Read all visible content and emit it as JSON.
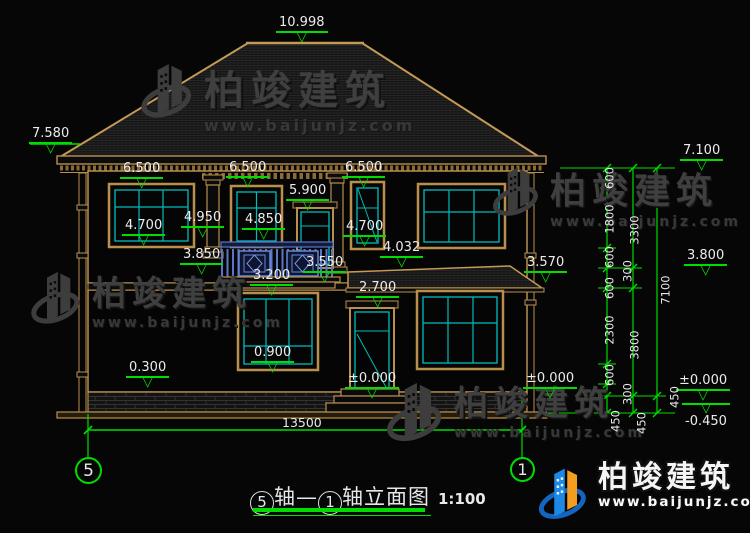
{
  "watermark": {
    "brand": "柏竣建筑",
    "url": "www.baijunjz.com"
  },
  "footer_logo": {
    "brand": "柏竣建筑",
    "url": "www.baijunjz.com"
  },
  "title": {
    "axis1": "5",
    "mid": "轴—",
    "axis2": "1",
    "tail": "轴立面图",
    "scale": "1:100"
  },
  "axes": {
    "left": "5",
    "right": "1"
  },
  "elev": {
    "ridge": "10.998",
    "eaveL": "7.580",
    "eaveR": "7.100",
    "l2a": "6.500",
    "l2b": "6.500",
    "l2c": "6.500",
    "doorTop2": "5.900",
    "sill2a": "4.700",
    "mid2": "4.950",
    "sill2b": "4.850",
    "sill2c": "4.700",
    "rail": "3.850",
    "balcTop": "3.550",
    "balcFloor": "3.200",
    "canopyL": "4.032",
    "canopyR": "3.570",
    "midR": "3.800",
    "door1": "2.700",
    "sill1": "0.900",
    "plinth": "0.300",
    "gndDoor": "±0.000",
    "gndWall": "±0.000",
    "gndChain": "±0.000",
    "basement": "-0.450"
  },
  "vdim": {
    "v1": "600",
    "v2": "1800",
    "v3": "600",
    "v4": "600",
    "v5": "2300",
    "v6": "600",
    "v7": "450",
    "v8": "3300",
    "v9": "300",
    "v10": "3800",
    "v11": "300",
    "v12": "450",
    "v13": "7100",
    "v14": "450"
  },
  "hdim": {
    "total": "13500"
  }
}
